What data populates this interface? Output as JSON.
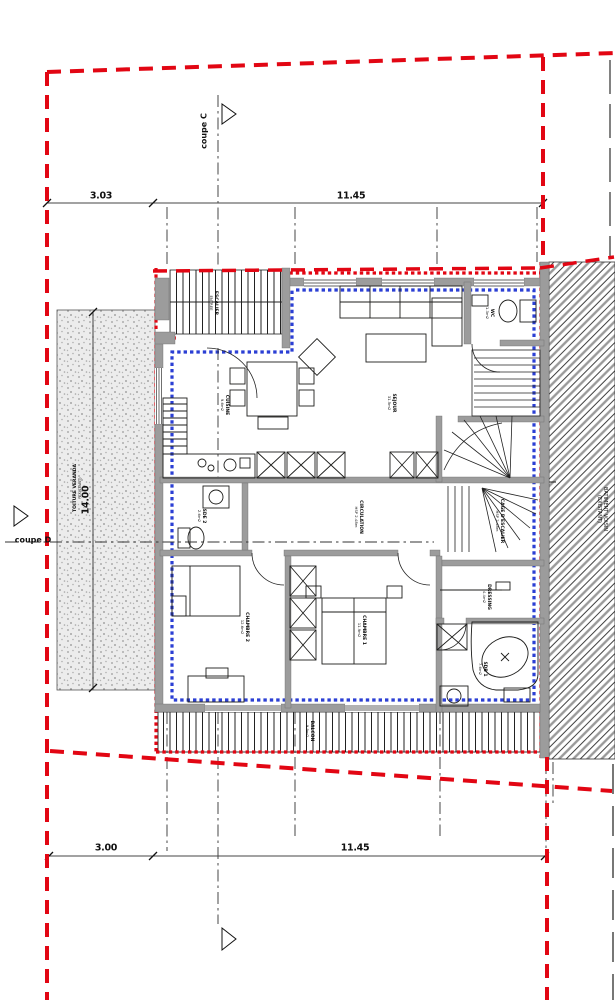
{
  "markers": {
    "coupe_c": "coupe C",
    "coupe_d": "coupe D"
  },
  "dimensions": {
    "top": [
      "3.03",
      "11.45"
    ],
    "bottom": [
      "3.00",
      "11.45"
    ],
    "left_vertical": "14.00"
  },
  "rooms": {
    "entry_stair": {
      "name": "ESCALIER",
      "detail": "ENTREE"
    },
    "sejour": {
      "name": "SEJOUR",
      "detail": "31.5m2"
    },
    "wc": {
      "name": "WC",
      "detail": "1.3m2"
    },
    "cuisine": {
      "name": "CUISINE",
      "detail": "9.6m2"
    },
    "sde": {
      "name": "SDE 2",
      "detail": "2.6m2"
    },
    "circulation": {
      "name": "CIRCULATION",
      "detail": "HSP 2.48m"
    },
    "stair_hall": {
      "name": "CAGE D'ESCALIER",
      "detail": "HSP 2.48m"
    },
    "chambre2": {
      "name": "CHAMBRE 2",
      "detail": "12.6m2"
    },
    "chambre1": {
      "name": "CHAMBRE 1",
      "detail": "11.9m2"
    },
    "dressing": {
      "name": "DRESSING",
      "detail": "4.4m2"
    },
    "sdb": {
      "name": "SDB 1",
      "detail": "7.6m2"
    },
    "balcon": {
      "name": "BALCON",
      "detail": "9.9m2"
    }
  },
  "annotations": {
    "terrace_line1": "TOITURE VERANDA",
    "terrace_line2": "(EXISTANT)",
    "neighbor_line1": "BATIMENT VOISIN",
    "neighbor_line2": "(EXISTANT)"
  },
  "colors": {
    "boundary_red": "#e20613",
    "insulation_blue": "#2b3fd4",
    "wall_gray": "#9c9c9c"
  }
}
